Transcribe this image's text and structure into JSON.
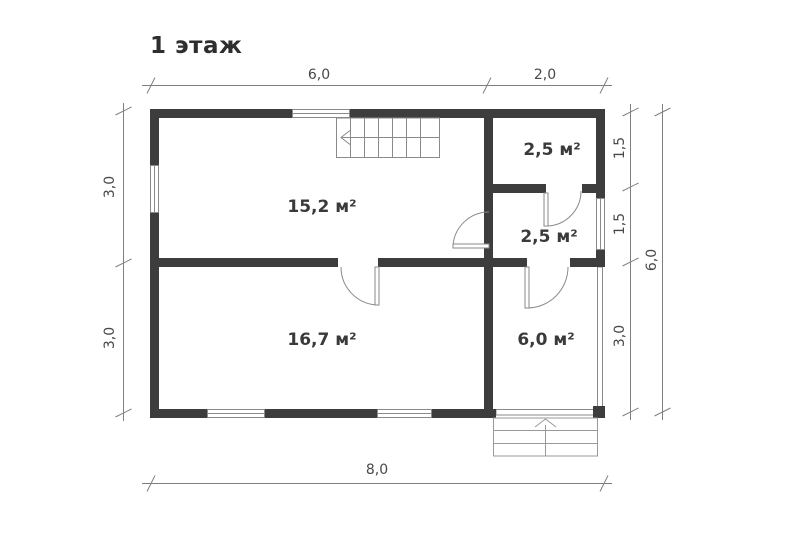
{
  "title": "1 этаж",
  "rooms": {
    "living": {
      "area": "15,2 м²"
    },
    "closet": {
      "area": "2,5 м²"
    },
    "hallway": {
      "area": "2,5 м²"
    },
    "bedroom": {
      "area": "16,7 м²"
    },
    "veranda": {
      "area": "6,0 м²"
    }
  },
  "dimensions": {
    "top_segment_1": "6,0",
    "top_segment_2": "2,0",
    "left_segment_1": "3,0",
    "left_segment_2": "3,0",
    "right_segment_1": "1,5",
    "right_segment_2": "1,5",
    "right_segment_3": "3,0",
    "right_total": "6,0",
    "bottom_total": "8,0"
  },
  "colors": {
    "wall": "#3d3d3d",
    "thin_line": "#8a8a8a",
    "dimension_line": "#7f7f7f",
    "text": "#3a3a3a",
    "background": "#ffffff"
  }
}
